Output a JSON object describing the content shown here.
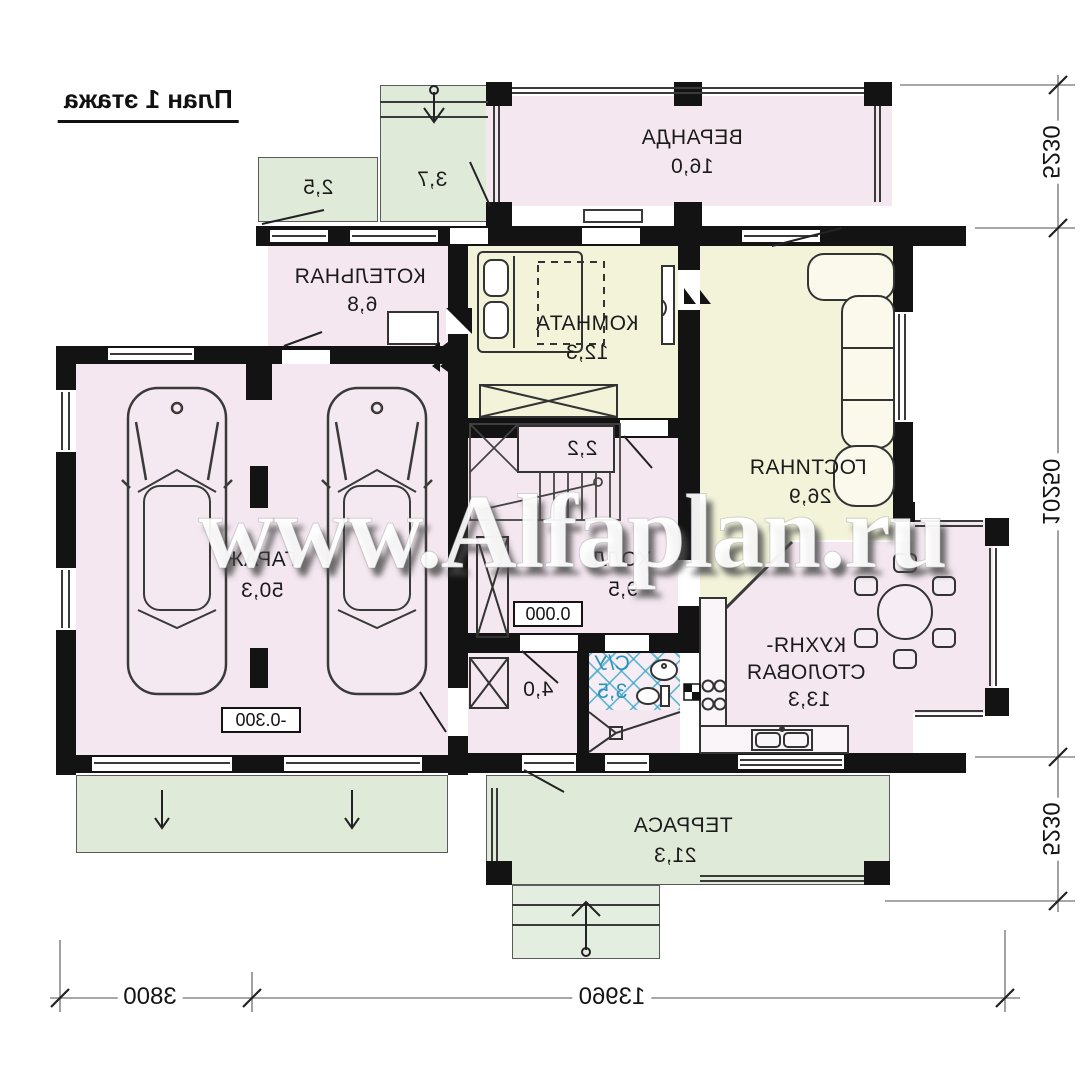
{
  "title": "План 1 этажа",
  "watermark": "www.Alfaplan.ru",
  "rooms": {
    "veranda": {
      "label": "ВЕРАНДА",
      "area": "16,0"
    },
    "porch_left": {
      "area": "2,5"
    },
    "porch_entry": {
      "area": "3,7"
    },
    "boiler": {
      "label": "КОТЕЛЬНАЯ",
      "area": "6,8"
    },
    "bedroom": {
      "label": "КОМНАТА",
      "area": "12,3"
    },
    "living": {
      "label": "ГОСТИНАЯ",
      "area": "26,9"
    },
    "garage": {
      "label": "ГАРАЖ",
      "area": "50,3"
    },
    "stairs": {
      "area": "2,2"
    },
    "hall": {
      "label": "ХОЛЛ",
      "area": "9,5"
    },
    "wc": {
      "label": "С/У",
      "area": "3,5"
    },
    "vestibule": {
      "area": "4,0"
    },
    "kitchen": {
      "label_line1": "КУХНЯ-",
      "label_line2": "СТОЛОВАЯ",
      "area": "13,3"
    },
    "terrace": {
      "label": "ТЕРРАСА",
      "area": "21,3"
    }
  },
  "level_marks": {
    "hall": "0.000",
    "garage": "-0.300"
  },
  "dimensions": {
    "right": [
      "5230",
      "10250",
      "5230"
    ],
    "bottom": [
      "3800",
      "13960"
    ]
  },
  "colors": {
    "wall": "#131313",
    "room_pink": "#f4e7f0",
    "room_yellow": "#f2f3d8",
    "outdoor_green": "#dfead9",
    "tile_blue": "#3aa9c9"
  }
}
